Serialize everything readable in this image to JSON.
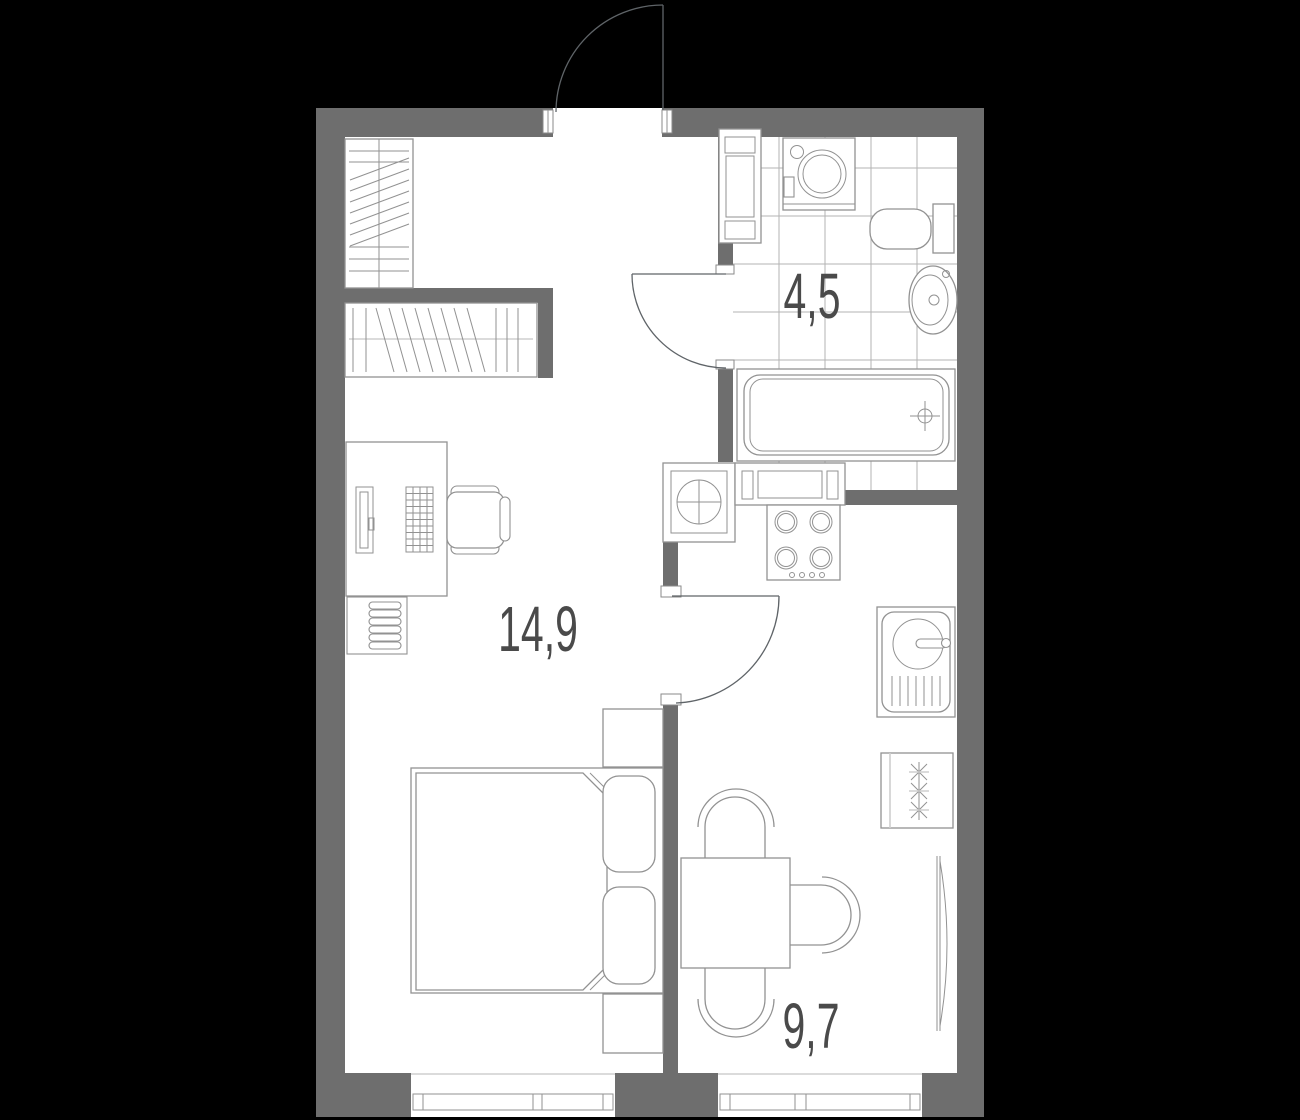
{
  "plan": {
    "title": "apartment-floor-plan",
    "rooms": {
      "living": {
        "name": "living-room",
        "area": "14,9"
      },
      "bathroom": {
        "name": "bathroom",
        "area": "4,5"
      },
      "kitchen": {
        "name": "kitchen",
        "area": "9,7"
      }
    },
    "furniture_symbols": [
      "wardrobe-tall-icon",
      "wardrobe-low-icon",
      "desk-icon",
      "monitor-icon",
      "keyboard-icon",
      "office-chair-icon",
      "radiator-icon",
      "bed-icon",
      "pillow-icon",
      "nightstand-icon",
      "towel-dryer-icon",
      "washing-machine-icon",
      "toilet-icon",
      "washbasin-icon",
      "bathtub-icon",
      "ventilation-shaft-icon",
      "kitchen-counter-icon",
      "cooktop-icon",
      "kitchen-sink-icon",
      "refrigerator-icon",
      "dining-table-icon",
      "dining-chair-icon",
      "window-icon",
      "door-swing-icon"
    ],
    "colors": {
      "background": "#000000",
      "wall": "#6e6e6e",
      "floor": "#ffffff",
      "furniture_line": "#929292",
      "light_line": "#cfcfcf",
      "tile_line": "#b3b3b3",
      "door_line": "#5f6468",
      "label_text": "#4a4a4a"
    }
  }
}
